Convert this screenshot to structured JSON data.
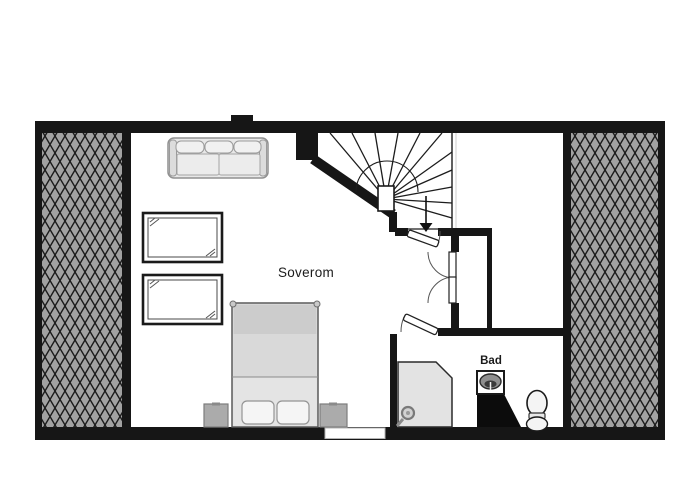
{
  "rooms": {
    "bedroom": {
      "label": "Soverom"
    },
    "bathroom": {
      "label": "Bad"
    }
  },
  "stairs": {
    "type": "winder-staircase",
    "direction_icon": "arrow-down"
  },
  "icons": {
    "shower": "shower-head-circle",
    "sink": "washbasin-oval",
    "toilet": "toilet-top-view",
    "window_marks": "double-diagonal-ticks"
  },
  "furniture": {
    "sofa": "three-seat-sofa",
    "bed": "double-bed-two-pillows",
    "nightstand_count": 2,
    "roof_window_count": 2,
    "wardrobe_door_count": 2,
    "attic_hatch_zones": [
      "left",
      "right"
    ]
  },
  "colors": {
    "wall": "#161616",
    "hatch_background": "#a2a2a2",
    "hatch_line": "#1b1b1b",
    "furniture_gray": "#e6e6e6",
    "counter_black": "#0c0c0c",
    "background": "#ffffff"
  }
}
